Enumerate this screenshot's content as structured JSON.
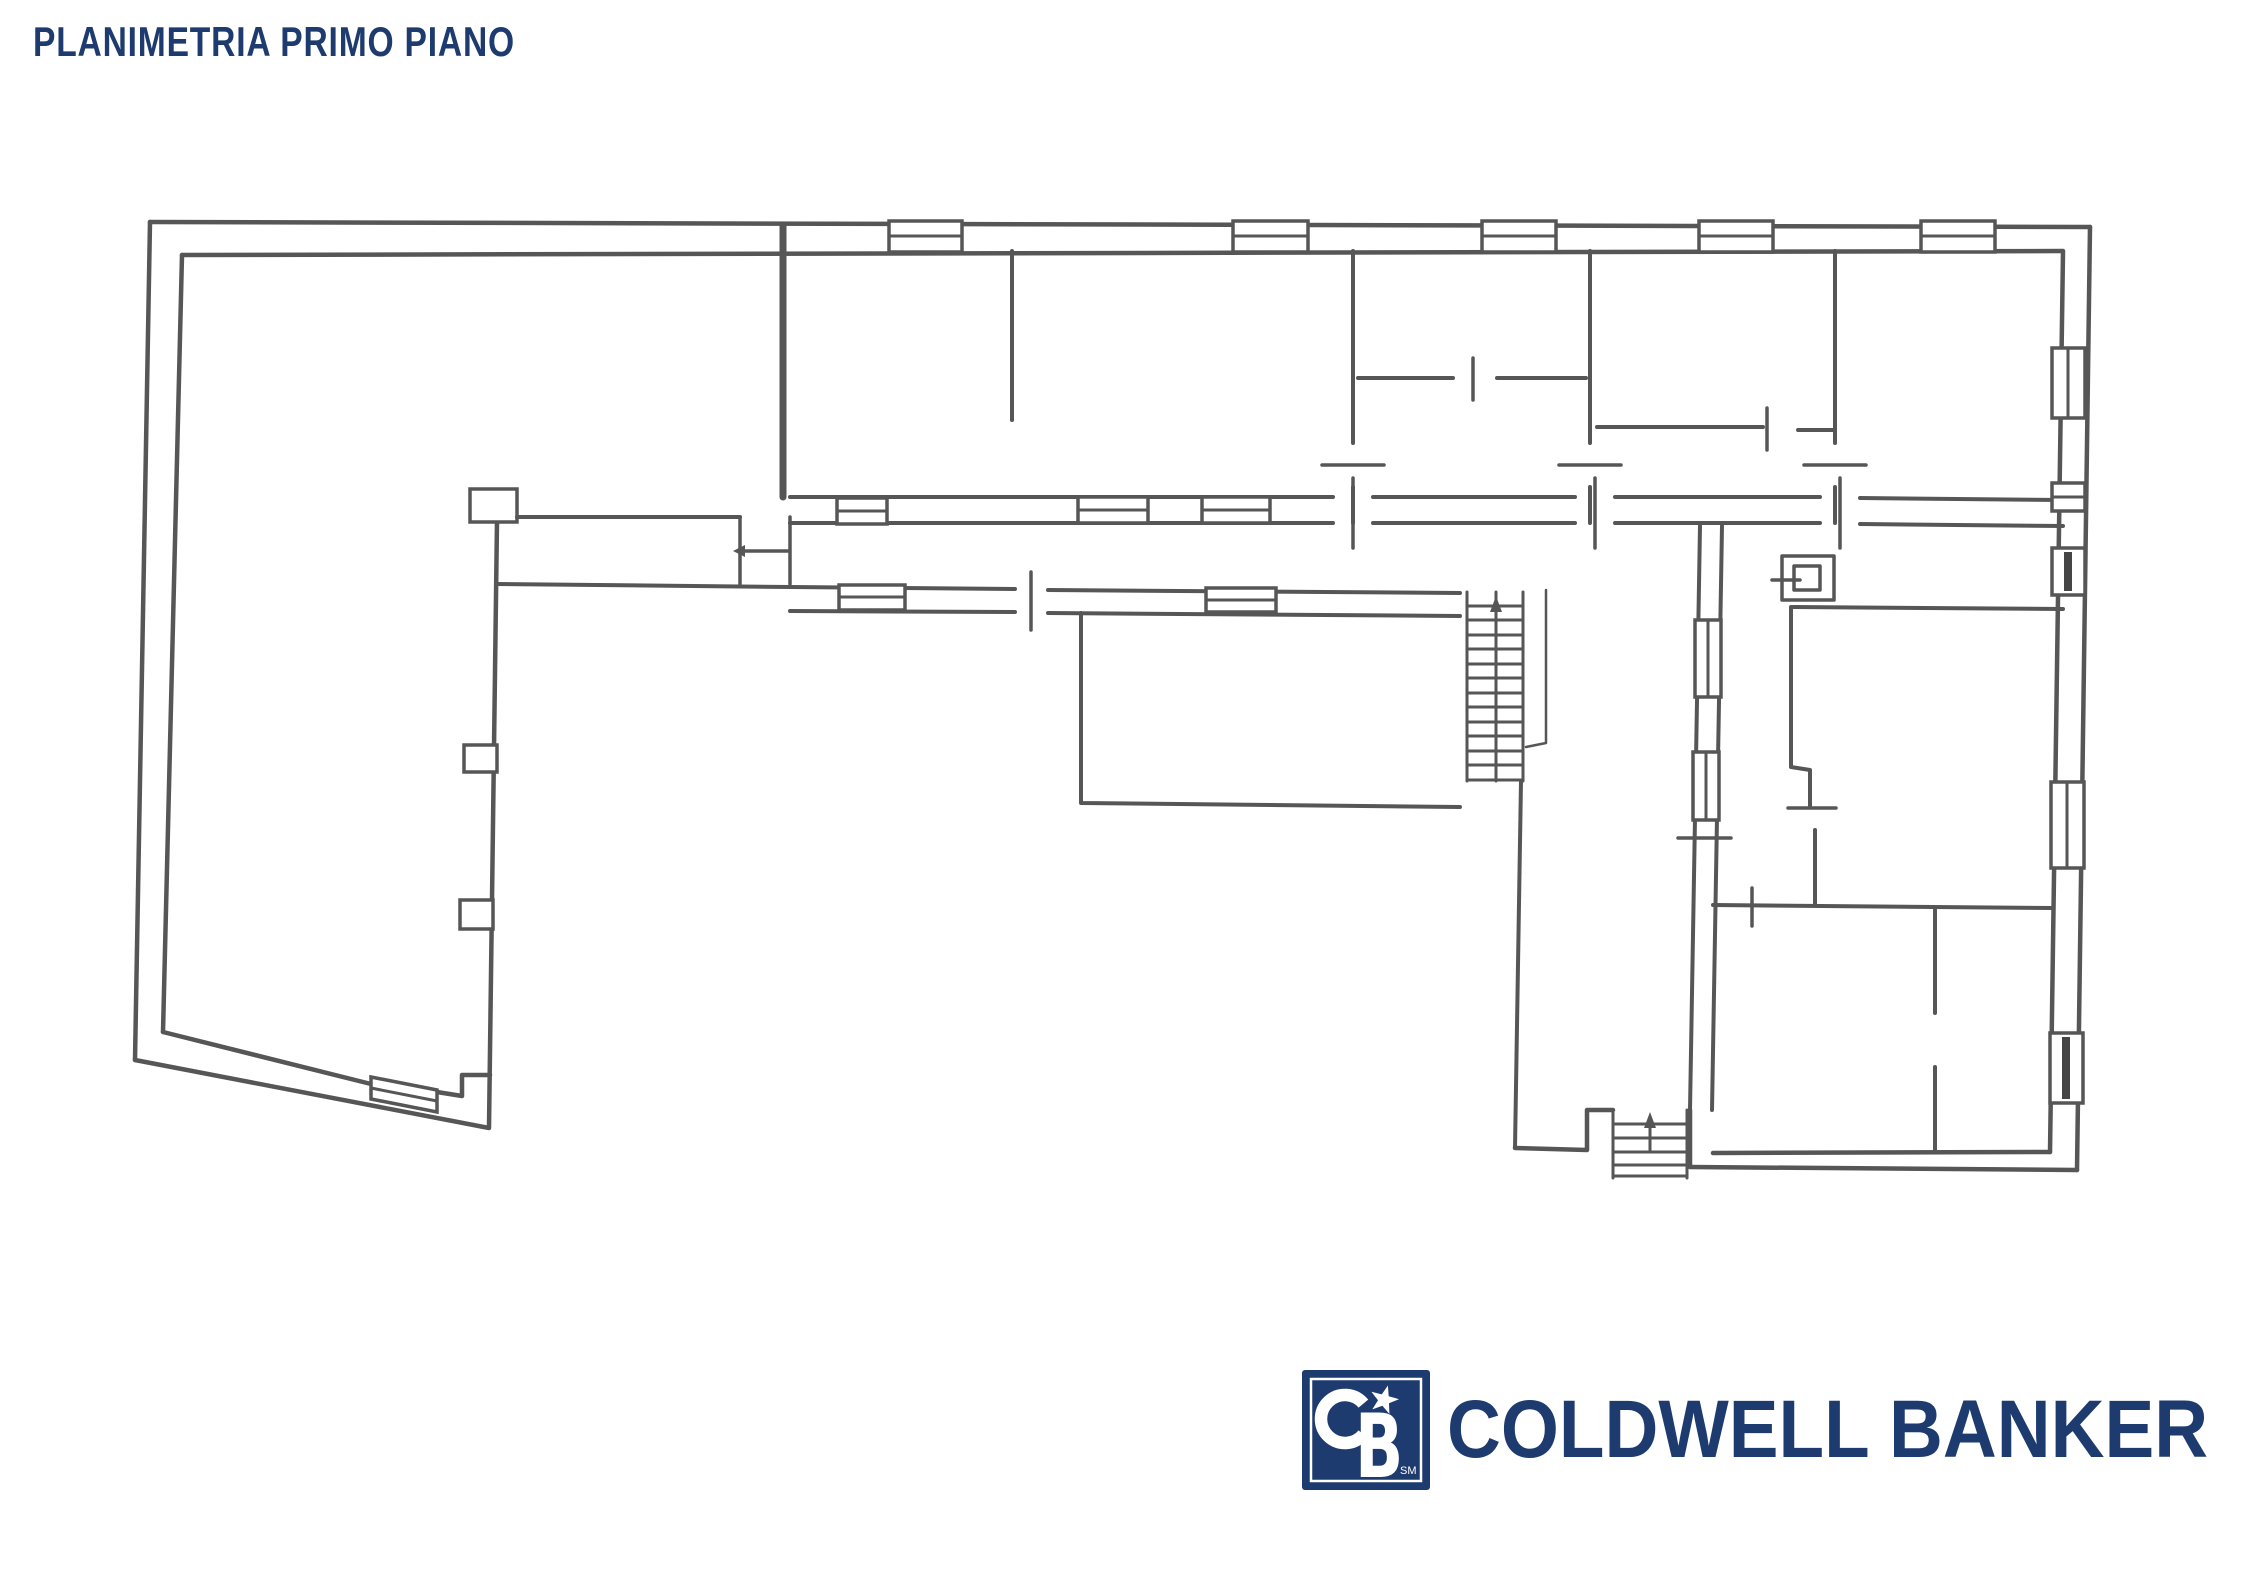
{
  "page": {
    "width": 2245,
    "height": 1587,
    "background": "#ffffff"
  },
  "header": {
    "title": "PLANIMETRIA PRIMO PIANO",
    "title_color": "#1e3b6f"
  },
  "floorplan": {
    "ink_color": "#3f3f3f",
    "description": "Hand-drafted first floor plan: L-shaped building with a large left hall, five rooms along the top wing, a central corridor, a main staircase, an inner porch, and a right wing of rooms with a secondary staircase",
    "staircase_count": 2
  },
  "brand": {
    "wordmark": "COLDWELL BANKER",
    "monogram": "CB",
    "monogram_b": "B",
    "trademark": "SM",
    "navy": "#1e3b6f",
    "white": "#ffffff"
  }
}
